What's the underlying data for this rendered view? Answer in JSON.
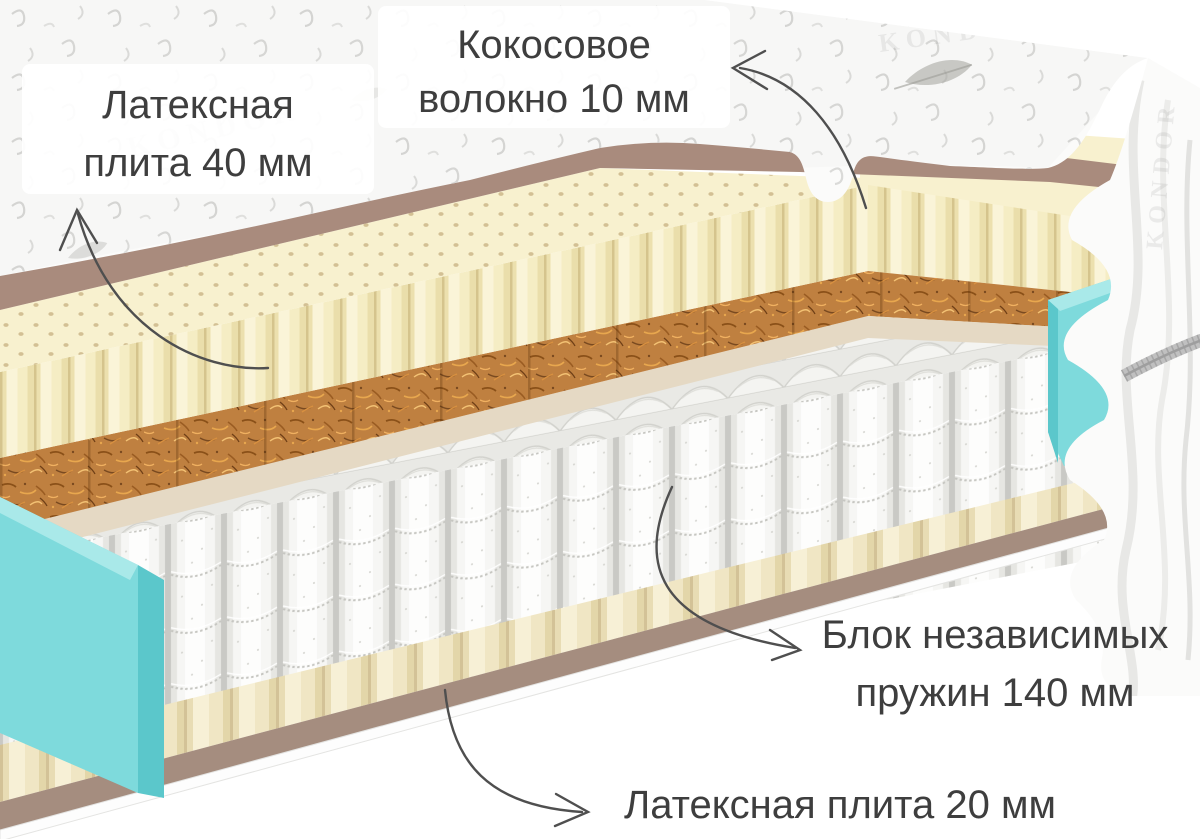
{
  "diagram_labels": {
    "latex_top": {
      "line1": "Латексная",
      "line2": "плита 40 мм"
    },
    "coconut": {
      "line1": "Кокосовое",
      "line2": "волокно 10 мм"
    },
    "springs": {
      "line1": "Блок независимых",
      "line2": "пружин 140 мм"
    },
    "latex_bottom": {
      "line1": "Латексная плита  20 мм"
    }
  },
  "brand_embroidery": "KONDOR",
  "colors": {
    "label_text": "#3e3e3e",
    "arrow": "#4f4f4f",
    "quilt": "#fbfbfa",
    "cover_backing": "#a98b7d",
    "cover_backing_bottom": "#a58d7f",
    "latex_base": "#f8f1cf",
    "underlay": "#e5d9c4",
    "coconut_base": "#bf8040",
    "side_foam": "#7edadc",
    "side_foam_dark": "#5bc7cb",
    "side_foam_light": "#a9e9e9",
    "spring_white": "#fafaf9",
    "zipper": "#c0c0c0"
  }
}
